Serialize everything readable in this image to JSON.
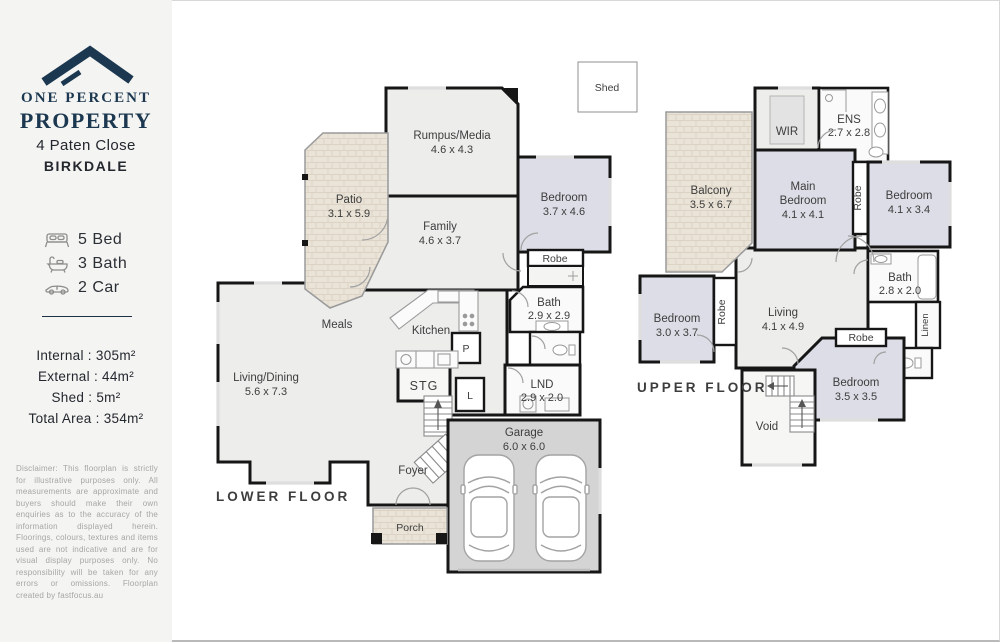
{
  "sidebar": {
    "logo_line1": "ONE PERCENT",
    "logo_line2": "PROPERTY",
    "address1": "4 Paten Close",
    "address2": "BIRKDALE",
    "features": [
      {
        "icon": "bed-icon",
        "label": "5 Bed"
      },
      {
        "icon": "bath-icon",
        "label": "3 Bath"
      },
      {
        "icon": "car-icon",
        "label": "2 Car"
      }
    ],
    "areas": [
      "Internal : 305m²",
      "External : 44m²",
      "Shed : 5m²",
      "Total Area : 354m²"
    ],
    "disclaimer": "Disclaimer: This floorplan is strictly for illustrative purposes only. All measurements are approximate and buyers should make their own enquiries as to the accuracy of the information displayed herein. Floorings, colours, textures and items used are not indicative and are for visual display purposes only. No responsibility will be taken for any errors or omissions. Floorplan created by fastfocus.au"
  },
  "shed": {
    "label": "Shed"
  },
  "lower": {
    "title": "LOWER FLOOR",
    "rooms": {
      "rumpus": {
        "name": "Rumpus/Media",
        "dims": "4.6 x 4.3"
      },
      "patio": {
        "name": "Patio",
        "dims": "3.1 x 5.9"
      },
      "family": {
        "name": "Family",
        "dims": "4.6 x 3.7"
      },
      "bedroom": {
        "name": "Bedroom",
        "dims": "3.7 x 4.6"
      },
      "robe": {
        "name": "Robe"
      },
      "meals": {
        "name": "Meals"
      },
      "kitchen": {
        "name": "Kitchen"
      },
      "pantry": {
        "name": "P"
      },
      "bath": {
        "name": "Bath",
        "dims": "2.9 x 2.9"
      },
      "stg": {
        "name": "STG"
      },
      "linen": {
        "name": "L"
      },
      "lnd": {
        "name": "LND",
        "dims": "2.9 x 2.0"
      },
      "living": {
        "name": "Living/Dining",
        "dims": "5.6 x 7.3"
      },
      "foyer": {
        "name": "Foyer"
      },
      "garage": {
        "name": "Garage",
        "dims": "6.0 x 6.0"
      },
      "porch": {
        "name": "Porch"
      }
    }
  },
  "upper": {
    "title": "UPPER FLOOR",
    "rooms": {
      "balcony": {
        "name": "Balcony",
        "dims": "3.5 x 6.7"
      },
      "wir": {
        "name": "WIR"
      },
      "ens": {
        "name": "ENS",
        "dims": "2.7 x 2.8"
      },
      "main": {
        "line1": "Main",
        "line2": "Bedroom",
        "dims": "4.1 x 4.1"
      },
      "robe1": {
        "name": "Robe"
      },
      "bedroom2": {
        "name": "Bedroom",
        "dims": "4.1 x 3.4"
      },
      "bath": {
        "name": "Bath",
        "dims": "2.8 x 2.0"
      },
      "linen": {
        "name": "Linen"
      },
      "bedroom3": {
        "name": "Bedroom",
        "dims": "3.0 x 3.7"
      },
      "robe2": {
        "name": "Robe"
      },
      "living": {
        "name": "Living",
        "dims": "4.1 x 4.9"
      },
      "robe3": {
        "name": "Robe"
      },
      "bedroom4": {
        "name": "Bedroom",
        "dims": "3.5 x 3.5"
      },
      "void": {
        "name": "Void"
      }
    }
  },
  "colors": {
    "brand_navy": "#1c3850",
    "wall": "#161616",
    "bedroom_fill": "#dcdde6",
    "floor_fill": "#ededec",
    "garage_fill": "#d4d4d4",
    "outdoor_fill": "#e9e3d8"
  }
}
